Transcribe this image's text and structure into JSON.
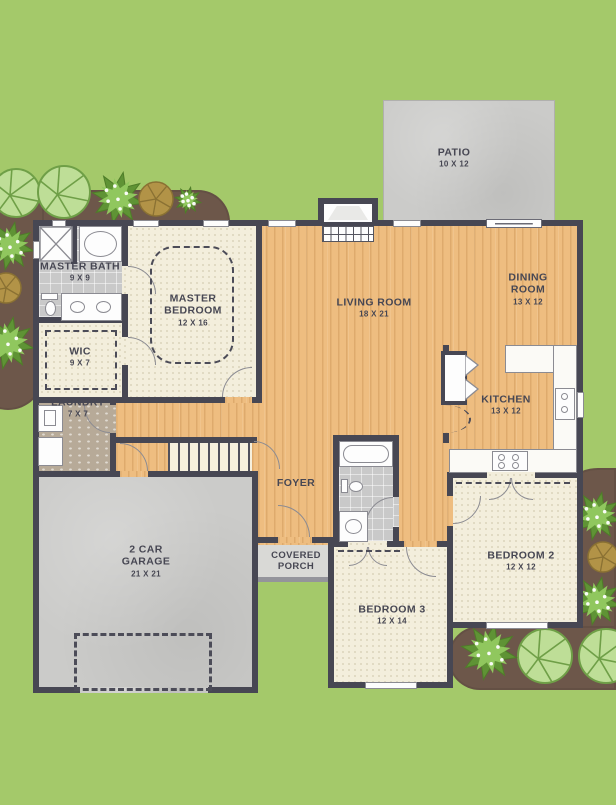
{
  "palette": {
    "grass": "#a4c96a",
    "landscape_bed": "#6d574a",
    "wall": "#474753",
    "wood_floor": "#eebd80",
    "carpet": "#f3eedc",
    "bath_tile": "#c9c9c9",
    "laundry_tile": "#b7aa98",
    "concrete": "#cbcbc9",
    "counter": "#fbfaf6",
    "tree_fill": "#bede97",
    "bush_fill": "#90c75e",
    "label_text": "#474753"
  },
  "rooms": {
    "master_bath": {
      "name": "MASTER BATH",
      "dims": "9 X 9"
    },
    "master_bedroom": {
      "name": "MASTER BEDROOM",
      "dims": "12 X 16"
    },
    "wic": {
      "name": "WIC",
      "dims": "9 X 7"
    },
    "laundry": {
      "name": "LAUNDRY",
      "dims": "7 X 7"
    },
    "garage": {
      "name": "2 CAR GARAGE",
      "dims": "21 X 21"
    },
    "living_room": {
      "name": "LIVING ROOM",
      "dims": "18 X 21"
    },
    "dining_room": {
      "name": "DINING ROOM",
      "dims": "13 X 12"
    },
    "kitchen": {
      "name": "KITCHEN",
      "dims": "13 X 12"
    },
    "foyer": {
      "name": "FOYER"
    },
    "covered_porch": {
      "name": "COVERED PORCH"
    },
    "patio": {
      "name": "PATIO",
      "dims": "10 X 12"
    },
    "bedroom2": {
      "name": "BEDROOM 2",
      "dims": "12 X 12"
    },
    "bedroom3": {
      "name": "BEDROOM 3",
      "dims": "12 X 14"
    }
  }
}
